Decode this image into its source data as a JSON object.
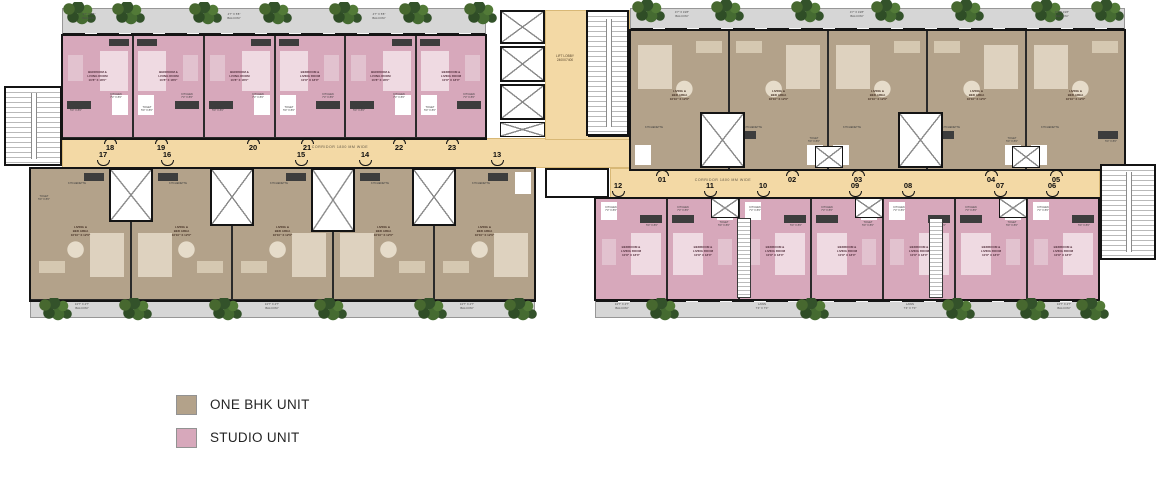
{
  "legend": {
    "items": [
      {
        "id": "one-bhk",
        "label": "ONE BHK UNIT",
        "color": "#b3a28a"
      },
      {
        "id": "studio",
        "label": "STUDIO UNIT",
        "color": "#d7a8bb"
      }
    ]
  },
  "corridors": {
    "left": "CORRIDOR 1800 MM WIDE",
    "right": "CORRIDOR 1800 MM WIDE"
  },
  "lift_lobby": "LIFT LOBBY\n2400X7400",
  "units": {
    "left_top": [
      "18",
      "19",
      "20",
      "21",
      "22",
      "23"
    ],
    "left_bottom": [
      "17",
      "16",
      "15",
      "14",
      "13"
    ],
    "right_top": [
      "01",
      "02",
      "03",
      "04",
      "05"
    ],
    "right_bottom": [
      "12",
      "11",
      "10",
      "09",
      "08",
      "07",
      "06"
    ]
  },
  "rooms": {
    "studio_label": "BEDROOM &\nLIVING ROOM\n10'8\" X 18'0\"",
    "onebhk_label": "LIVING &\nBED AREA\n16'10\" X 12'6\"",
    "balcony_left": "4'7\" X 5'8\"\nBALCONY",
    "balcony_right": "4'7\" X 19'8\"\nBALCONY",
    "balcony_bottom": "13'7\" X 4'7\"\nBALCONY",
    "kitchen": "KITCHEN\n7'3\" X 8'6\"",
    "toilet": "TOILET\n5'0\" X 8'0\"",
    "kitchenette": "KITCHENETTE",
    "lawn": "LAWN\n7'4\" X 7'0\""
  },
  "colors": {
    "corridor": "#f3d9a5",
    "one_bhk": "#b3a28a",
    "studio": "#d7a8bb",
    "balcony": "#d6d6d6"
  }
}
